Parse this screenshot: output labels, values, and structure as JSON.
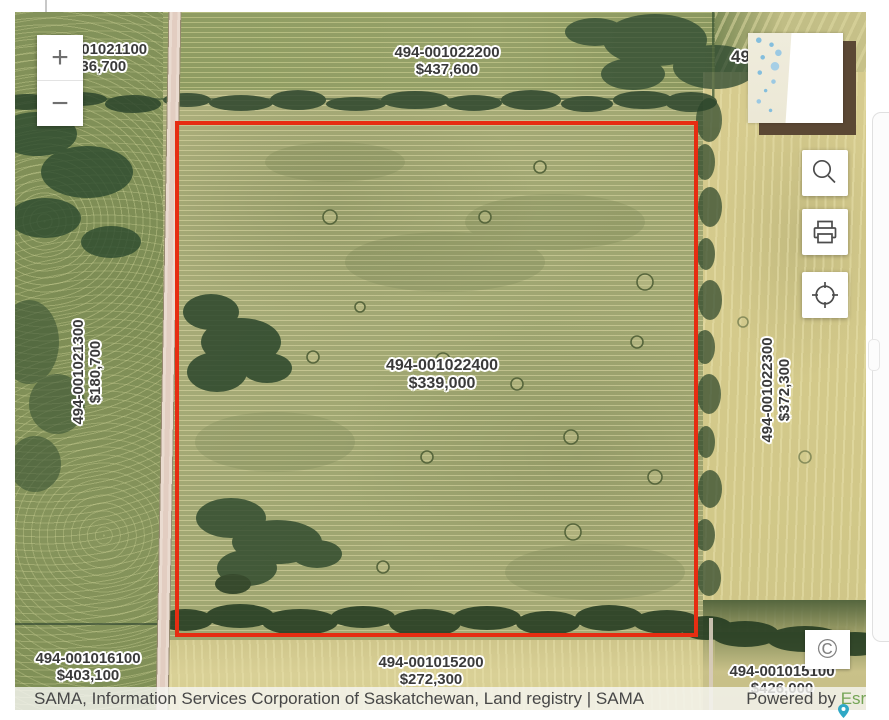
{
  "map": {
    "controls": {
      "zoom_in_label": "+",
      "zoom_out_label": "−",
      "copyright_symbol": "©"
    },
    "tools": {
      "search": "magnifier",
      "print": "printer",
      "locate": "crosshair-circle"
    },
    "parcels": {
      "top_left": {
        "id": "494-001021100",
        "value": "$436,700"
      },
      "top_center": {
        "id": "494-001022200",
        "value": "$437,600"
      },
      "top_right_fragment": {
        "id": "49"
      },
      "left": {
        "id": "494-001021300",
        "value": "$180,700"
      },
      "center": {
        "id": "494-001022400",
        "value": "$339,000"
      },
      "right": {
        "id": "494-001022300",
        "value": "$372,300"
      },
      "bottom_left": {
        "id": "494-001016100",
        "value": "$403,100"
      },
      "bottom_center": {
        "id": "494-001015200",
        "value": "$272,300"
      },
      "bottom_right": {
        "id": "494-001015100",
        "value": "$426,000"
      }
    },
    "highlight": {
      "parcel_id": "494-001022400",
      "outline_color": "#e62d12"
    }
  },
  "attribution": {
    "sources": "SAMA, Information Services Corporation of Saskatchewan, Land registry | SAMA",
    "powered_by_prefix": "Powered by ",
    "powered_by_brand": "Esri",
    "brand_color": "#74a455"
  },
  "colors": {
    "parcel_outline": "#e62d12",
    "label_text": "#3a3a3a",
    "road": "#eadbd0",
    "field_center": "#a8ab76",
    "field_right": "#d3c98a",
    "field_left": "#7d8d55",
    "trees": "#24402a"
  }
}
